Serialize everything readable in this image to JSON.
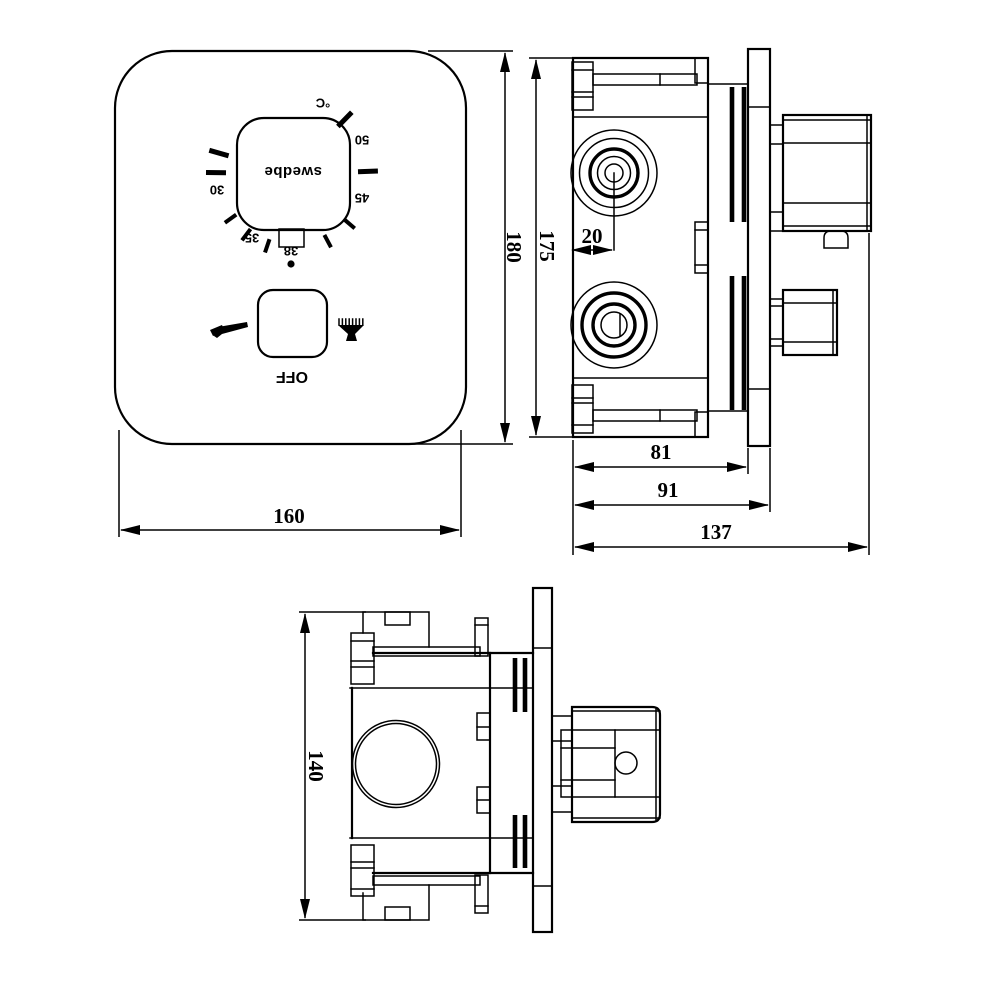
{
  "front_view": {
    "brand": "swedbe",
    "dial": {
      "unit": "°C",
      "t50": "50",
      "t45": "45",
      "t38": "38",
      "t35": "35",
      "t30": "30"
    },
    "off": "OFF",
    "width_dim": "160",
    "height_dim": "180"
  },
  "side_view": {
    "height_dim": "175",
    "center_offset_dim": "20",
    "body_depth_dim": "81",
    "plate_depth_dim": "91",
    "total_depth_dim": "137"
  },
  "bottom_view": {
    "height_dim": "140"
  },
  "colors": {
    "line": "#000000",
    "background": "#ffffff"
  }
}
